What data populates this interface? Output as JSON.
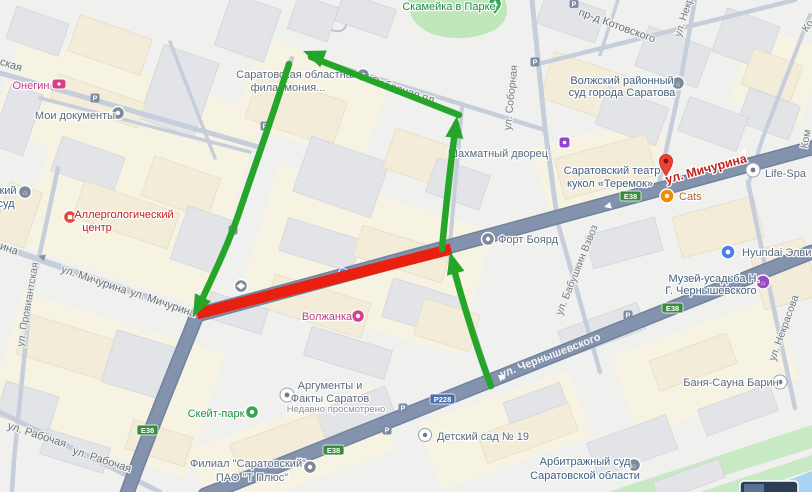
{
  "annotations": {
    "closed_street": "ул. Мичурина",
    "closure_color": "#e91f10",
    "detour_color": "#26a52b"
  },
  "route_badges": [
    {
      "text": "E38"
    },
    {
      "text": "E38"
    },
    {
      "text": "E38"
    },
    {
      "text": "E38"
    },
    {
      "text": "Р228"
    }
  ],
  "streets": [
    {
      "t": "ская"
    },
    {
      "t": "ина"
    },
    {
      "t": "ул. Мичурина"
    },
    {
      "t": "ул. Мичурина"
    },
    {
      "t": "ул. Провиантская"
    },
    {
      "t": "ул. Рабочая"
    },
    {
      "t": "ул. Рабочая"
    },
    {
      "t": "ул. Чернышевского"
    },
    {
      "t": "Соборная пл."
    },
    {
      "t": "ул. Соборная"
    },
    {
      "t": "пр-д Котовского"
    },
    {
      "t": "ул. Некр"
    },
    {
      "t": "ул. Бабушкин Взвоз"
    },
    {
      "t": "ул. Некрасова"
    },
    {
      "t": "Ко"
    },
    {
      "t": "Ком"
    },
    {
      "t": "ул. Мичурина"
    }
  ],
  "pois": [
    {
      "t1": "Онегин"
    },
    {
      "t1": "Мои документы"
    },
    {
      "t1": "Скамейка в Парке"
    },
    {
      "t1": "Саратовская областная",
      "t2": "филармония..."
    },
    {
      "t1": "Шахматный дворец"
    },
    {
      "t1": "Волжский районный",
      "t2": "суд города Саратова"
    },
    {
      "t1": "Саратовский театр",
      "t2": "кукол «Теремок»"
    },
    {
      "t1": "Life-Spa"
    },
    {
      "t1": "Cats"
    },
    {
      "t1": "Форт Боярд"
    },
    {
      "t1": "Аллергологический",
      "t2": "центр"
    },
    {
      "t1": "Hyundai Элвис П"
    },
    {
      "t1": "Музей-усадьба Н.",
      "t2": "Г. Чернышевского"
    },
    {
      "t1": "Волжанка"
    },
    {
      "t1": "Скейт-парк"
    },
    {
      "t1": "Аргументы и",
      "t2": "Факты Саратов",
      "sub": "Недавно просмотрено"
    },
    {
      "t1": "Филиал \"Саратовский\"",
      "t2": "ПАО \"Т Плюс\""
    },
    {
      "t1": "Детский сад № 19"
    },
    {
      "t1": "Арбитражный суд",
      "t2": "Саратовской области"
    },
    {
      "t1": "Баня-Сауна Барин"
    },
    {
      "t1": "кий",
      "t2": "суд"
    }
  ],
  "icons": {
    "parking": "P",
    "civic": "⌂"
  }
}
